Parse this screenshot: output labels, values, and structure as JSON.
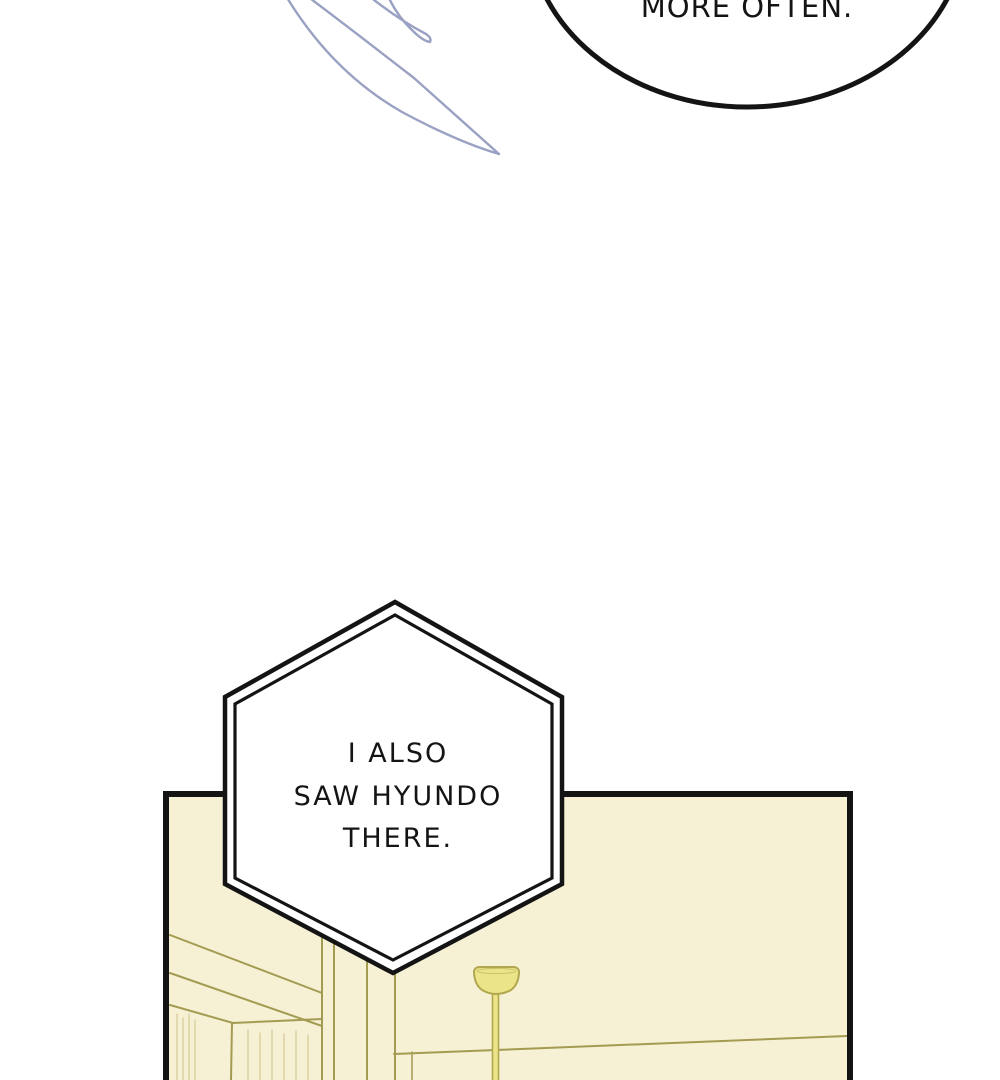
{
  "page": {
    "background": "#ffffff"
  },
  "speech_bubble": {
    "text": "MORE OFTEN."
  },
  "hex_bubble": {
    "line1": "I ALSO",
    "line2": "SAW HYUNDO",
    "line3": "THERE."
  },
  "colors": {
    "page_background": "#ffffff",
    "ink": "#141414",
    "panel_background": "#f6f0d4",
    "room_line": "#a49b52",
    "room_line_faint": "#ded5a4",
    "lamp_fill": "#ece489",
    "lamp_outline": "#b1a74f",
    "hair_stroke": "#9aa1c2"
  }
}
